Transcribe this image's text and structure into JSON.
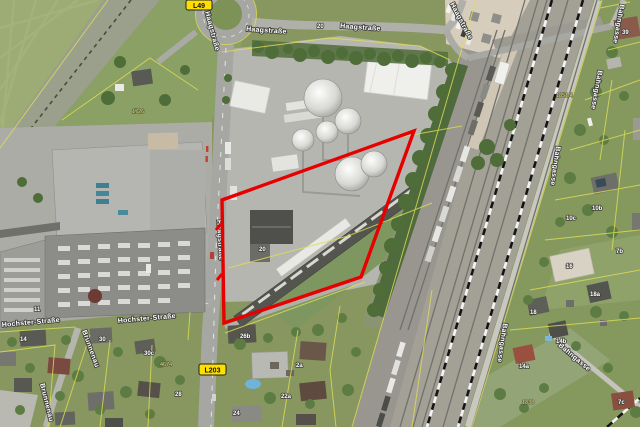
{
  "map_type": "aerial orthophoto with cadastral overlay and property highlight",
  "colors": {
    "highlight": "#e60000",
    "cadastral": "#dfdf52",
    "shield_bg": "#ffdf00"
  },
  "highlight": {
    "color": "#e60000",
    "shape": "quadrilateral",
    "vertices": [
      [
        414,
        131
      ],
      [
        222,
        200
      ],
      [
        224,
        323
      ],
      [
        361,
        277
      ]
    ]
  },
  "shields": {
    "l49": "L49",
    "l203": "L203"
  },
  "streets": {
    "haagstrasse": "Haagstraße",
    "hochster_strasse": "Hochster-Straße",
    "brunnenau": "Brunnenau",
    "bahngasse": "Bahngasse"
  },
  "house_numbers": {
    "n20": "20",
    "n20b": "20",
    "n39": "39",
    "n11": "11",
    "n14": "14",
    "n30": "30",
    "n30c": "30c",
    "n28": "28",
    "n26b": "26b",
    "n24": "24",
    "n22a": "22a",
    "n2a": "2a",
    "n10b": "10b",
    "n10c": "10c",
    "n16": "16",
    "n18": "18",
    "n18a": "18a",
    "n14b": "14b",
    "n14a": "14a",
    "n7b": "7b",
    "n7c": "7c"
  },
  "parcel_numbers": {
    "p1726": "1726",
    "p1851_4": "1851/4",
    "p1838": "1838",
    "p4674": "4674"
  }
}
